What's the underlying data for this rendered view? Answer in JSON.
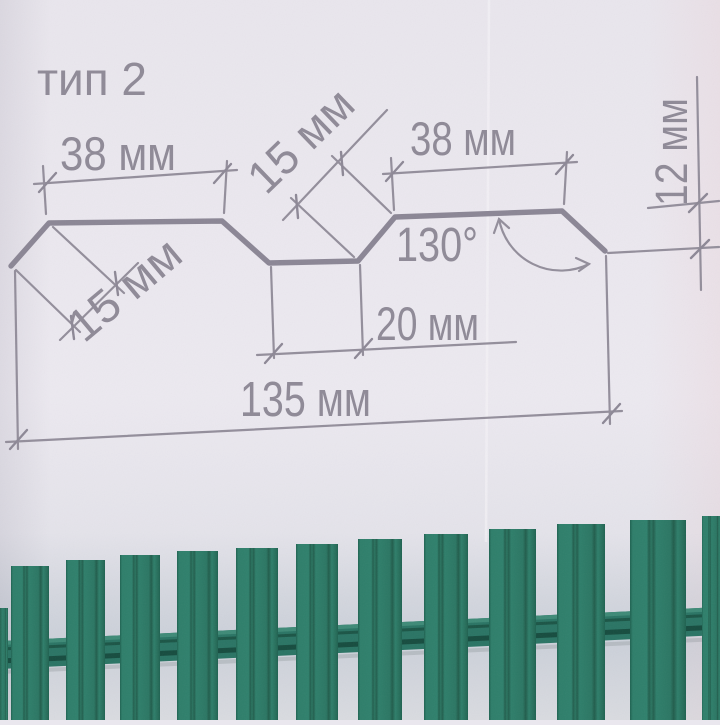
{
  "title": "тип 2",
  "diagram": {
    "dim_top_left": "38 мм",
    "dim_edge_left": "15 мм",
    "dim_slope_mid": "15 мм",
    "dim_top_right": "38 мм",
    "angle_label": "130°",
    "dim_valley_bottom": "20 мм",
    "dim_height_right": "12 мм",
    "dim_overall_width": "135 мм"
  },
  "colors": {
    "paper": "#eae7ee",
    "drawing_line": "#8d8896",
    "label_text": "#8f8a97",
    "picket_green": "#2e7e6a",
    "picket_rib_dark": "#1e5c4b",
    "rail_green": "#2a7464",
    "photo_background": "#ccd1da"
  },
  "fence": {
    "pickets": [
      {
        "x": -4,
        "w": 12,
        "top": 608
      },
      {
        "x": 11,
        "w": 38,
        "top": 566
      },
      {
        "x": 66,
        "w": 39,
        "top": 560
      },
      {
        "x": 120,
        "w": 40,
        "top": 555
      },
      {
        "x": 177,
        "w": 41,
        "top": 551
      },
      {
        "x": 236,
        "w": 42,
        "top": 548
      },
      {
        "x": 296,
        "w": 42,
        "top": 544
      },
      {
        "x": 358,
        "w": 44,
        "top": 539
      },
      {
        "x": 424,
        "w": 44,
        "top": 534
      },
      {
        "x": 489,
        "w": 47,
        "top": 529
      },
      {
        "x": 557,
        "w": 48,
        "top": 524
      },
      {
        "x": 630,
        "w": 56,
        "top": 520
      },
      {
        "x": 702,
        "w": 20,
        "top": 516
      }
    ]
  }
}
